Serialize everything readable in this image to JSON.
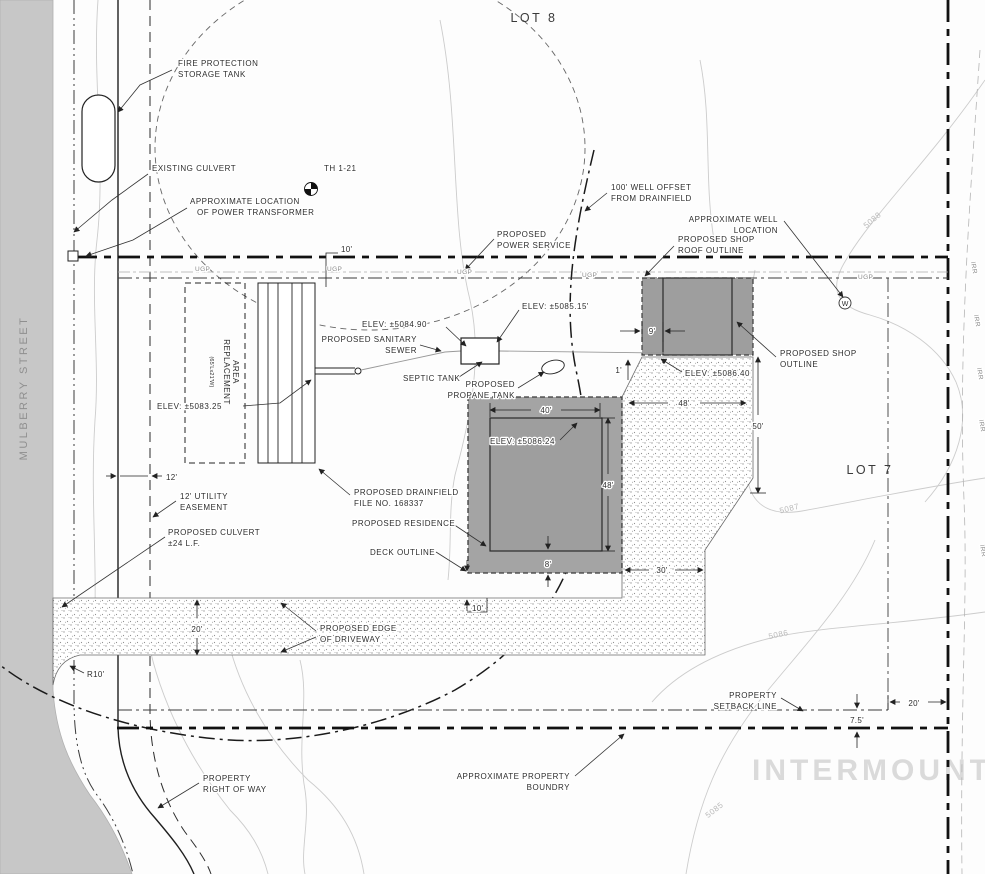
{
  "d": {
    "lots": {
      "lot8": "LOT 8",
      "lot7": "LOT 7"
    },
    "street_name": "MULBERRY STREET",
    "watermark": "INTERMOUNTAIN",
    "labels": {
      "fire_tank": [
        "FIRE PROTECTION",
        "STORAGE TANK"
      ],
      "existing_culvert": "EXISTING CULVERT",
      "transformer": [
        "APPROXIMATE LOCATION",
        "OF POWER TRANSFORMER"
      ],
      "test_hole": "TH 1-21",
      "well_offset": [
        "100' WELL OFFSET",
        "FROM DRAINFIELD"
      ],
      "well_location": [
        "APPROXIMATE WELL",
        "LOCATION"
      ],
      "power_service": [
        "PROPOSED",
        "POWER SERVICE"
      ],
      "shop_roof": [
        "PROPOSED SHOP",
        "ROOF OUTLINE"
      ],
      "shop_outline": [
        "PROPOSED SHOP",
        "OUTLINE"
      ],
      "elev_septic_a": "ELEV: ±5085.15'",
      "elev_septic_b": "ELEV: ±5084.90",
      "sanitary_sewer": [
        "PROPOSED SANITARY",
        "SEWER"
      ],
      "septic_tank": "SEPTIC TANK",
      "propane_tank": [
        "PROPOSED",
        "PROPANE TANK"
      ],
      "elev_shop": "ELEV: ±5086.40",
      "elev_replacement": "ELEV: ±5083.25",
      "elev_residence": "ELEV: ±5086.24",
      "replacement_area": [
        "REPLACEMENT",
        "AREA",
        "(65'Lx21'W)"
      ],
      "drainfield": [
        "PROPOSED DRAINFIELD",
        "FILE NO. 168337"
      ],
      "residence": "PROPOSED RESIDENCE",
      "deck": "DECK OUTLINE",
      "utility_easement": [
        "12' UTILITY",
        "EASEMENT"
      ],
      "proposed_culvert": [
        "PROPOSED CULVERT",
        "±24 L.F."
      ],
      "driveway_edge": [
        "PROPOSED EDGE",
        "OF DRIVEWAY"
      ],
      "setback": [
        "PROPERTY",
        "SETBACK LINE"
      ],
      "right_of_way": [
        "PROPERTY",
        "RIGHT OF WAY"
      ],
      "property_boundary": [
        "APPROXIMATE PROPERTY",
        "BOUNDRY"
      ]
    },
    "dims": {
      "power_offset": "10'",
      "shop_overhang": "9'",
      "shop_gap": "1'",
      "res_width": "40'",
      "res_depth": "48'",
      "drive_east": "48'",
      "shop_side": "50'",
      "deck_south": "8'",
      "deck_drive_gap": "10'",
      "drive_leg": "30'",
      "drive_width": "20'",
      "easement_width": "12'",
      "setback_east": "20'",
      "setback_south": "7.5'",
      "drive_radius": "R10'"
    },
    "contours": {
      "c5088": "5088",
      "c5087": "5087",
      "c5086": "5086",
      "c5085": "5085"
    },
    "utils": {
      "ugp": "UGP",
      "irr": "IRR",
      "well_symbol": "W"
    },
    "colors": {
      "street_gray": "#c7c7c7",
      "building_gray": "#9e9e9e",
      "line_black": "#1a1a1a",
      "contour_gray": "#c9c9c9",
      "watermark_gray": "#dadada"
    }
  }
}
